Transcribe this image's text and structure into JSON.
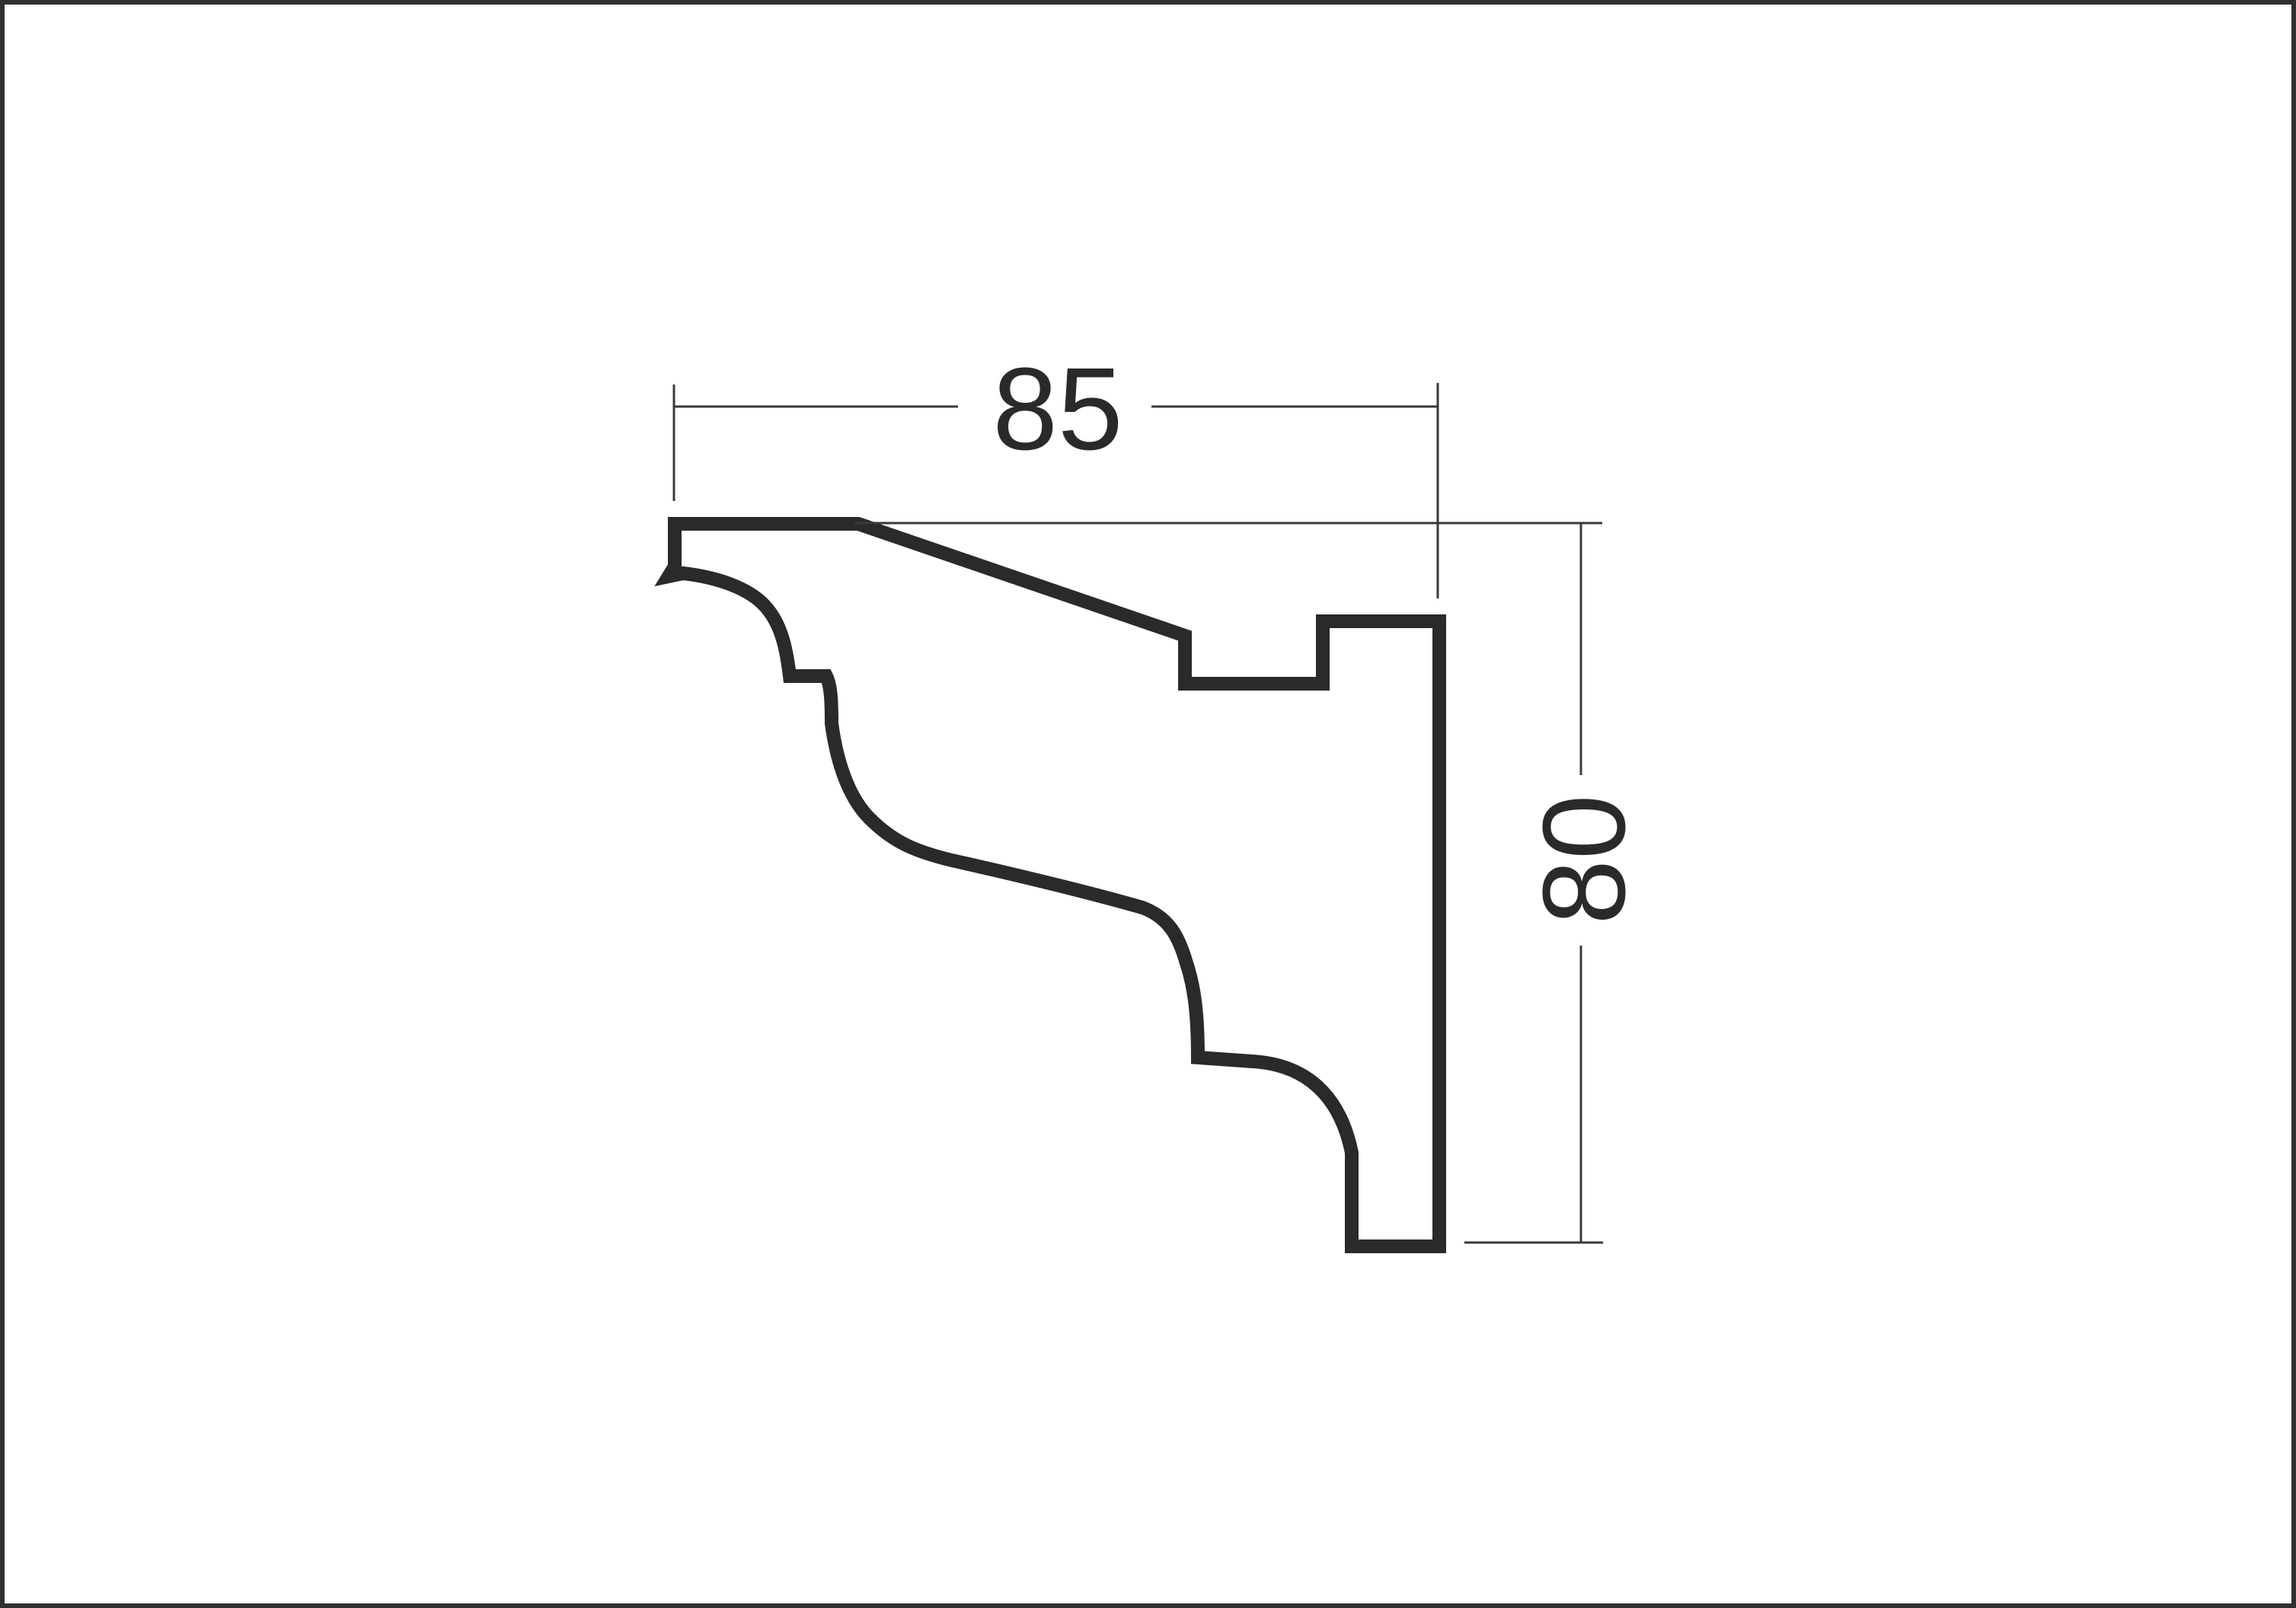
{
  "page": {
    "background": "#ffffff",
    "border_color": "#31302f"
  },
  "drawing": {
    "type": "molding-profile-cross-section",
    "outline_color": "#2b2a29",
    "fill_color": "#ffffff",
    "dimension_line_color": "#3a3938",
    "text_color": "#2b2a29",
    "width_dimension": {
      "label": "85"
    },
    "height_dimension": {
      "label": "80"
    }
  }
}
